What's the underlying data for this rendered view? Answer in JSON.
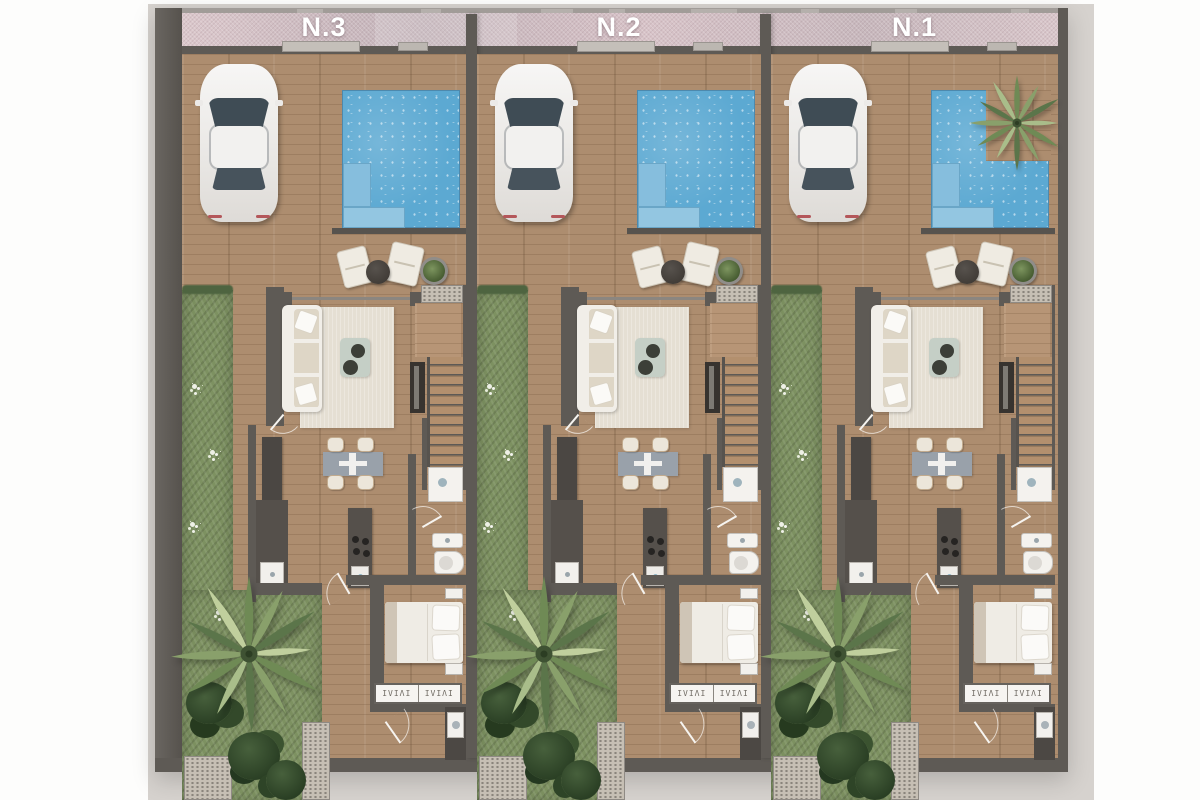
{
  "scene": {
    "description": "Top-down 3D render floor plan of three attached townhouses",
    "units_count": 3
  },
  "units": [
    {
      "id": "unit-n3",
      "label": "N.3"
    },
    {
      "id": "unit-n2",
      "label": "N.2"
    },
    {
      "id": "unit-n1",
      "label": "N.1",
      "pool_variant": "l-shaped-with-palm-planter"
    }
  ],
  "features_per_unit": [
    "driveway",
    "parked-car",
    "pool",
    "terrace-lounge",
    "planter",
    "sofa",
    "rug",
    "coffee-table",
    "tv-unit",
    "stairs",
    "dining-table",
    "kitchen-counter",
    "fridge",
    "kitchen-island",
    "shower",
    "washbasin",
    "toilet",
    "double-bed",
    "nightstands",
    "wardrobe",
    "utility-washer",
    "garden",
    "palm-tree",
    "flower-bushes"
  ],
  "wardrobe_glyphs": "ΙVΙΛΙ",
  "colors": {
    "page_background": "#fdfdfc",
    "render_background": "#d6d2ce",
    "wall": "#5e5a55",
    "roof_band_pink": "#d5c1c6",
    "wood_floor": "#ad8d6f",
    "pool_water": "#5ca9d2",
    "pool_steps": "#86bedd",
    "grass": "#7d9161",
    "palm_green": "#6f8a55",
    "rug": "#e5dfd3",
    "sofa_white": "#f1eee8",
    "counter_dark": "#55504b",
    "dining_table_gray": "#99a1aa",
    "fixture_white": "#f4f2ee",
    "label_text": "#ffffff"
  }
}
